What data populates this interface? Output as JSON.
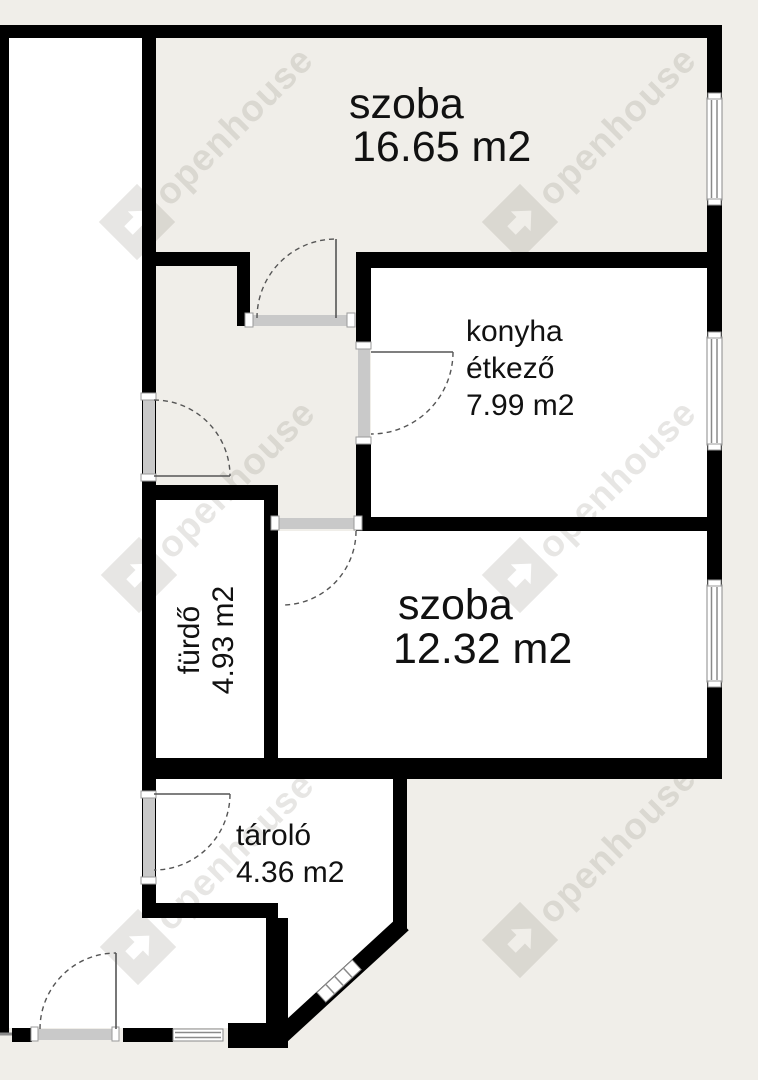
{
  "rooms": [
    {
      "name": "szoba",
      "area": "16.65 m2"
    },
    {
      "name": "konyha",
      "name2": "étkező",
      "area": "7.99 m2"
    },
    {
      "name": "szoba",
      "area": "12.32 m2"
    },
    {
      "name": "fürdő",
      "area": "4.93 m2"
    },
    {
      "name": "tároló",
      "area": "4.36 m2"
    }
  ],
  "watermark": {
    "text": "openhouse"
  },
  "colors": {
    "background": "#f0eee9",
    "room": "#ffffff",
    "wall": "#000000",
    "threshold": "#c9c9c9",
    "window_line": "#8a8a8a",
    "door_line": "#555555",
    "watermark": "rgba(110,105,92,0.17)",
    "label": "#111111"
  }
}
